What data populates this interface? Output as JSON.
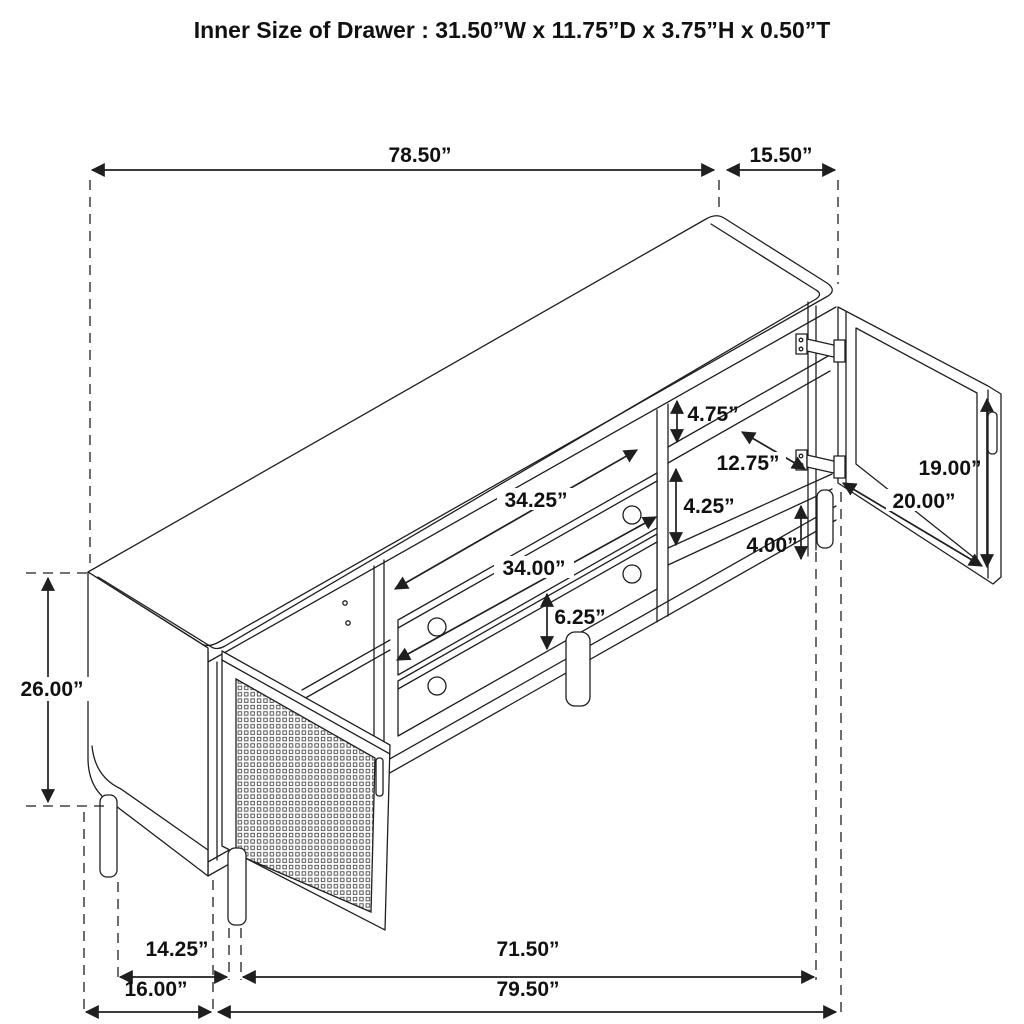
{
  "title": "Inner Size of Drawer : 31.50”W x 11.75”D x 3.75”H x 0.50”T",
  "dimensions": {
    "top_length": "78.50”",
    "top_depth": "15.50”",
    "cabinet_height": "26.00”",
    "upper_shelf_gap": "4.75”",
    "shelf_depth": "12.75”",
    "lower_shelf_gap": "4.25”",
    "base_height": "4.00”",
    "door_height": "19.00”",
    "door_width": "20.00”",
    "opening_width": "34.25”",
    "drawer_width": "34.00”",
    "drawer_front_height": "6.25”",
    "leg_inset": "14.25”",
    "leg_span": "71.50”",
    "side_depth": "16.00”",
    "overall_length": "79.50”"
  }
}
